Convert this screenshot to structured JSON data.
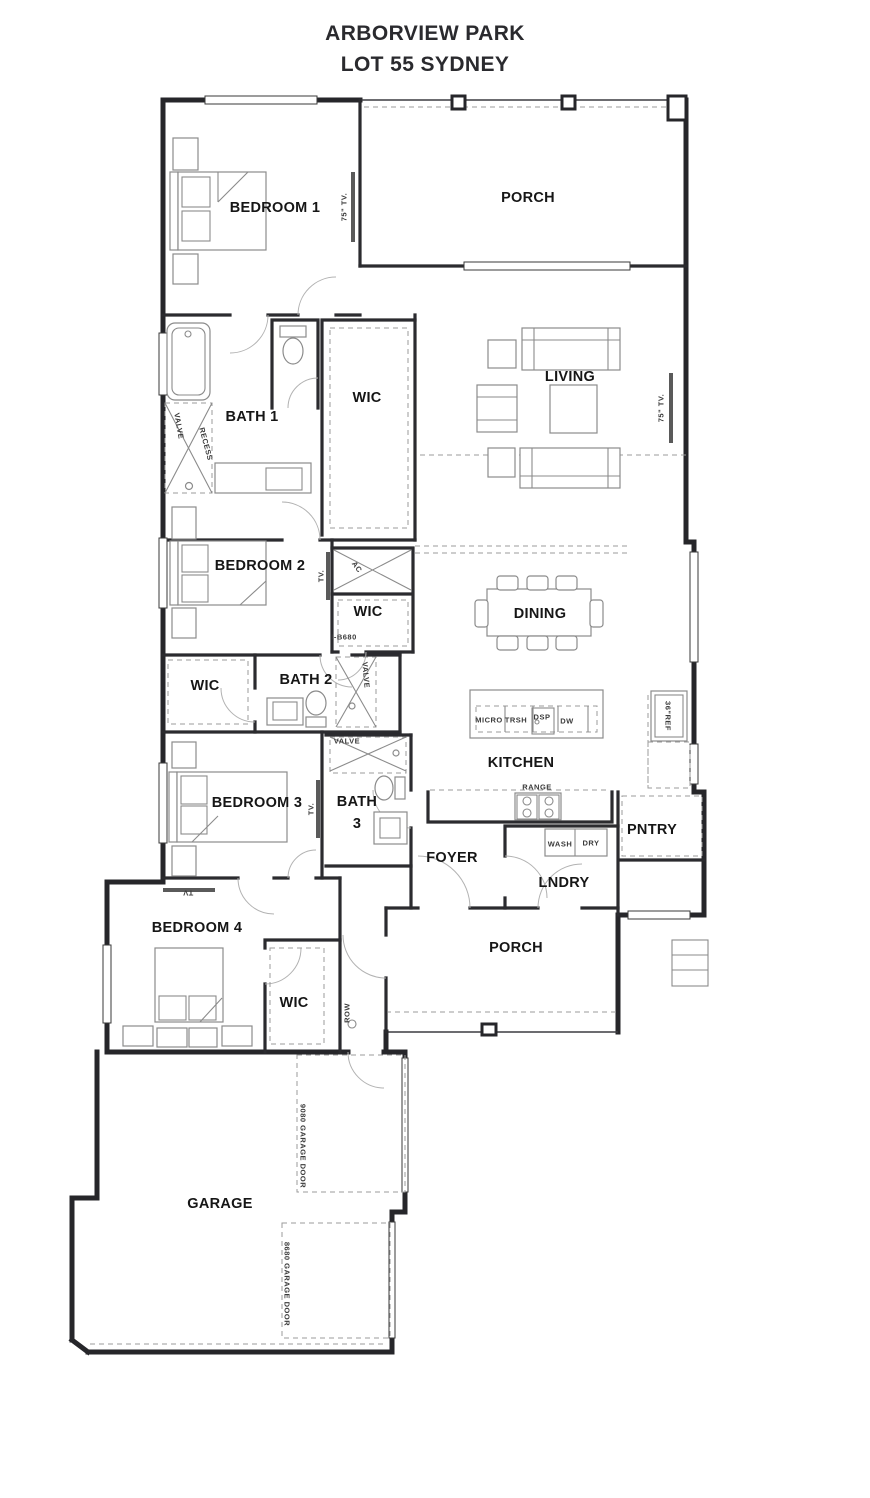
{
  "title": {
    "line1": "ARBORVIEW PARK",
    "line2": "LOT 55 SYDNEY"
  },
  "colors": {
    "ink": "#26262a",
    "furniture": "#8b8b8b"
  },
  "plan": {
    "rooms": [
      {
        "label": "BEDROOM 1",
        "x": 275,
        "y": 208
      },
      {
        "label": "PORCH",
        "x": 528,
        "y": 198
      },
      {
        "label": "LIVING",
        "x": 570,
        "y": 377
      },
      {
        "label": "BATH 1",
        "x": 252,
        "y": 417
      },
      {
        "label": "WIC",
        "x": 367,
        "y": 398
      },
      {
        "label": "BEDROOM 2",
        "x": 260,
        "y": 566
      },
      {
        "label": "WIC",
        "x": 368,
        "y": 612
      },
      {
        "label": "DINING",
        "x": 540,
        "y": 614
      },
      {
        "label": "WIC",
        "x": 205,
        "y": 686
      },
      {
        "label": "BATH 2",
        "x": 306,
        "y": 680
      },
      {
        "label": "KITCHEN",
        "x": 521,
        "y": 763
      },
      {
        "label": "BEDROOM 3",
        "x": 257,
        "y": 803
      },
      {
        "label": "BATH",
        "x": 357,
        "y": 802
      },
      {
        "label": "3",
        "x": 357,
        "y": 824
      },
      {
        "label": "FOYER",
        "x": 452,
        "y": 858
      },
      {
        "label": "PNTRY",
        "x": 652,
        "y": 830
      },
      {
        "label": "LNDRY",
        "x": 564,
        "y": 883
      },
      {
        "label": "BEDROOM 4",
        "x": 197,
        "y": 928
      },
      {
        "label": "PORCH",
        "x": 516,
        "y": 948
      },
      {
        "label": "WIC",
        "x": 294,
        "y": 1003
      },
      {
        "label": "GARAGE",
        "x": 220,
        "y": 1204
      }
    ],
    "annotations": [
      {
        "text": "75\" TV.",
        "x": 344,
        "y": 207,
        "rot": -90
      },
      {
        "text": "75\" TV.",
        "x": 661,
        "y": 408,
        "rot": -90
      },
      {
        "text": "VALVE",
        "x": 179,
        "y": 426,
        "rot": 80
      },
      {
        "text": "RECESS",
        "x": 206,
        "y": 444,
        "rot": 75
      },
      {
        "text": "TV.",
        "x": 321,
        "y": 576,
        "rot": -90
      },
      {
        "text": "AC",
        "x": 357,
        "y": 567,
        "rot": 55
      },
      {
        "text": "I-B680",
        "x": 344,
        "y": 637,
        "rot": 0
      },
      {
        "text": "VALVE",
        "x": 366,
        "y": 675,
        "rot": 85
      },
      {
        "text": "VALVE",
        "x": 347,
        "y": 741,
        "rot": 0
      },
      {
        "text": "MICRO",
        "x": 489,
        "y": 720,
        "rot": 0
      },
      {
        "text": "TRSH",
        "x": 516,
        "y": 720,
        "rot": 0
      },
      {
        "text": "DSP",
        "x": 542,
        "y": 717,
        "rot": 0
      },
      {
        "text": "DW",
        "x": 567,
        "y": 721,
        "rot": 0
      },
      {
        "text": "36\"REF",
        "x": 668,
        "y": 716,
        "rot": 90
      },
      {
        "text": "RANGE",
        "x": 537,
        "y": 787,
        "rot": 0
      },
      {
        "text": "WASH",
        "x": 560,
        "y": 844,
        "rot": 0
      },
      {
        "text": "DRY",
        "x": 591,
        "y": 843,
        "rot": 0
      },
      {
        "text": "TV.",
        "x": 311,
        "y": 809,
        "rot": -90
      },
      {
        "text": "TV",
        "x": 188,
        "y": 893,
        "rot": 180
      },
      {
        "text": "ROW",
        "x": 347,
        "y": 1013,
        "rot": -90
      },
      {
        "text": "9080 GARAGE DOOR",
        "x": 303,
        "y": 1146,
        "rot": 90
      },
      {
        "text": "8680 GARAGE DOOR",
        "x": 287,
        "y": 1284,
        "rot": 90
      }
    ]
  }
}
